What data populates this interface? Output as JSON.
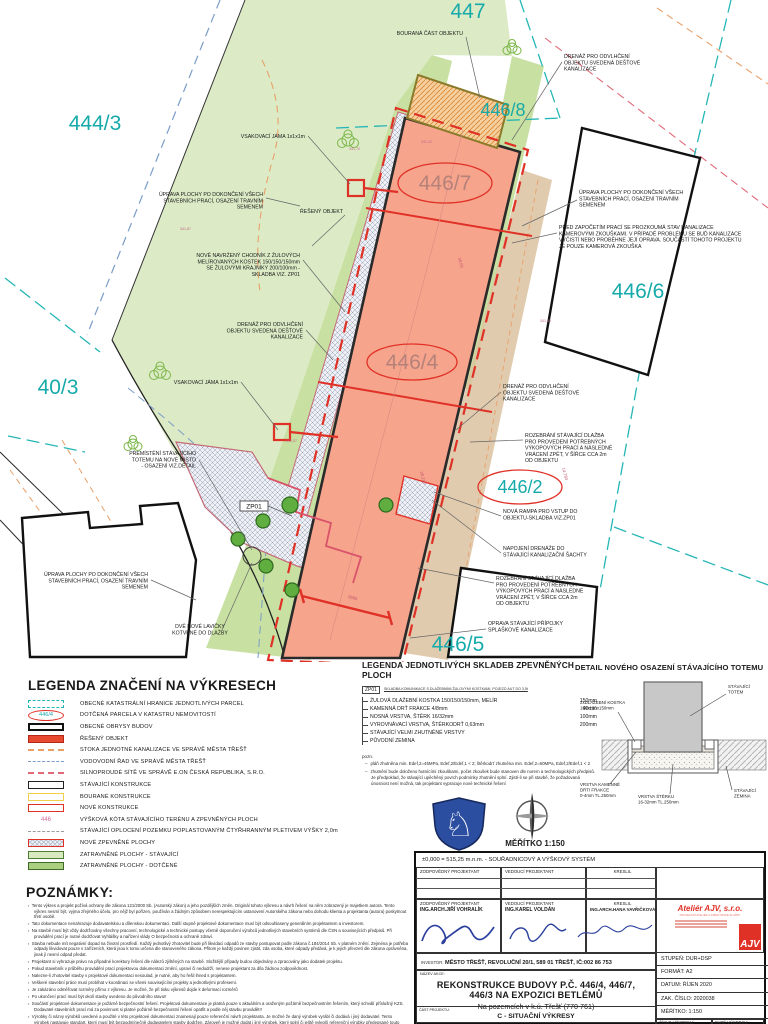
{
  "plan": {
    "parcels": [
      {
        "text": "444/3",
        "x": 95,
        "y": 130,
        "size": 21
      },
      {
        "text": "447",
        "x": 468,
        "y": 18,
        "size": 21
      },
      {
        "text": "446/8",
        "x": 503,
        "y": 116,
        "size": 18
      },
      {
        "text": "446/7",
        "x": 445,
        "y": 190,
        "size": 21,
        "ellipse": [
          445,
          183,
          47,
          20
        ],
        "color": "#b5827a"
      },
      {
        "text": "446/6",
        "x": 638,
        "y": 298,
        "size": 21
      },
      {
        "text": "40/3",
        "x": 58,
        "y": 394,
        "size": 21
      },
      {
        "text": "446/4",
        "x": 412,
        "y": 369,
        "size": 21,
        "ellipse": [
          412,
          362,
          45,
          18
        ],
        "color": "#b5827a"
      },
      {
        "text": "446/2",
        "x": 520,
        "y": 493,
        "size": 18,
        "ellipse": [
          520,
          487,
          42,
          17
        ]
      },
      {
        "text": "446/5",
        "x": 458,
        "y": 651,
        "size": 21
      }
    ],
    "zp01_tag": "ZP01",
    "annotations": [
      {
        "x": 305,
        "y": 138,
        "anchor": "end",
        "lines": [
          "VSAKOVACÍ JÁMA 1x1x1m"
        ],
        "leader": [
          [
            308,
            136
          ],
          [
            350,
            184
          ]
        ]
      },
      {
        "x": 263,
        "y": 196,
        "anchor": "end",
        "lines": [
          "ÚPRAVA PLOCHY PO DOKONČENÍ VŠECH",
          "STAVEBNÍCH PRACÍ, OSAZENÍ TRAVNÍM",
          "SEMENEM"
        ],
        "leader": [
          [
            266,
            198
          ],
          [
            300,
            206
          ]
        ]
      },
      {
        "x": 343,
        "y": 213,
        "anchor": "end",
        "lines": [
          "ŘEŠENÝ OBJEKT"
        ],
        "leader": [
          [
            345,
            215
          ],
          [
            312,
            246
          ]
        ]
      },
      {
        "x": 300,
        "y": 257,
        "anchor": "end",
        "lines": [
          "NOVĚ NAVRŽENÝ CHODNÍK  Z ŽULOVÝCH",
          "MELÍROVANÝCH KOSTEK 150/150/150mm",
          "SE ŽULOVÝMI KRAJNÍKY 200/100mm -",
          "SKLADBA VIZ. ZP01"
        ],
        "leader": [
          [
            303,
            260
          ],
          [
            345,
            312
          ]
        ]
      },
      {
        "x": 303,
        "y": 326,
        "anchor": "end",
        "lines": [
          "DRENÁŽ PRO ODVLHČENÍ",
          "OBJEKTU SVEDENÁ DEŠŤOVÉ",
          "KANALIZACE"
        ],
        "leader": [
          [
            306,
            330
          ],
          [
            333,
            360
          ]
        ]
      },
      {
        "x": 238,
        "y": 384,
        "anchor": "end",
        "lines": [
          "VSAKOVACÍ JÁMA 1x1x1m"
        ],
        "leader": [
          [
            241,
            382
          ],
          [
            278,
            430
          ]
        ]
      },
      {
        "x": 196,
        "y": 455,
        "anchor": "end",
        "lines": [
          "PŘEMÍSTĚNÍ STÁVAJÍCÍHO",
          "TOTEMU NA NOVÉ MÍSTO",
          "- OSAZENÍ VIZ.DETAIL"
        ],
        "leader": [
          [
            199,
            460
          ],
          [
            252,
            550
          ]
        ]
      },
      {
        "x": 148,
        "y": 576,
        "anchor": "end",
        "lines": [
          "ÚPRAVA PLOCHY PO DOKONČENÍ VŠECH",
          "STAVEBNÍCH PRACÍ, OSAZENÍ TRAVNÍM",
          "SEMENEM"
        ],
        "leader": [
          [
            151,
            580
          ],
          [
            196,
            600
          ]
        ]
      },
      {
        "x": 200,
        "y": 628,
        "anchor": "middle",
        "lines": [
          "DVĚ NOVÉ LAVIČKY",
          "KOTVENÉ DO DLAŽBY"
        ],
        "leader": [
          [
            222,
            630
          ],
          [
            252,
            563
          ]
        ]
      },
      {
        "x": 463,
        "y": 35,
        "anchor": "end",
        "lines": [
          "BOURANÁ ČÁST OBJEKTU"
        ],
        "leader": [
          [
            466,
            37
          ],
          [
            480,
            98
          ]
        ]
      },
      {
        "x": 564,
        "y": 58,
        "anchor": "start",
        "lines": [
          "DRENÁŽ PRO ODVLHČENÍ",
          "OBJEKTU SVEDENÁ DEŠŤOVÉ",
          "KANALIZACE"
        ],
        "leader": [
          [
            562,
            62
          ],
          [
            512,
            140
          ]
        ]
      },
      {
        "x": 579,
        "y": 194,
        "anchor": "start",
        "lines": [
          "ÚPRAVA PLOCHY PO DOKONČENÍ VŠECH",
          "STAVEBNÍCH PRACÍ, OSAZENÍ TRAVNÍM",
          "SEMENEM"
        ],
        "leader": [
          [
            577,
            200
          ],
          [
            522,
            226
          ]
        ]
      },
      {
        "x": 559,
        "y": 229,
        "anchor": "start",
        "lines": [
          "PŘED ZAPOČETÍM PRACÍ SE PROZKOUMÁ STAV KANALIZACE",
          "KAMEROVÝMI ZKOUŠKAMI. V PŘÍPADĚ PROBLÉMU SE BUĎ KANALIZACE",
          "VYČISTÍ NEBO PROBĚHNE JEJÍ OPRAVA. SOUČÁSTÍ TOHOTO PROJEKTU",
          "JE POUZE KAMEROVÁ ZKOUŠKA"
        ],
        "leader": [
          [
            557,
            233
          ],
          [
            512,
            243
          ]
        ]
      },
      {
        "x": 503,
        "y": 388,
        "anchor": "start",
        "lines": [
          "DRENÁŽ PRO ODVLHČENÍ",
          "OBJEKTU SVEDENÁ DEŠŤOVÉ",
          "KANALIZACE"
        ],
        "leader": [
          [
            501,
            392
          ],
          [
            456,
            430
          ]
        ]
      },
      {
        "x": 525,
        "y": 437,
        "anchor": "start",
        "lines": [
          "ROZEBRÁNÍ STÁVAJÍCÍ DLAŽBA",
          "PRO PROVEDENÍ POTŘEBNÝCH",
          "VÝKOPOVÝCH PRACÍ A NÁSLEDNÉ",
          "VRÁCENÍ ZPĚT, V ŠÍŘCE CCA 2m",
          "OD OBJEKTU"
        ],
        "leader": [
          [
            523,
            440
          ],
          [
            470,
            442
          ]
        ]
      },
      {
        "x": 503,
        "y": 513,
        "anchor": "start",
        "lines": [
          "NOVÁ RAMPA PRO VSTUP DO",
          "OBJEKTU-SKLADBA VIZ.ZP01"
        ],
        "leader": [
          [
            501,
            516
          ],
          [
            434,
            492
          ]
        ]
      },
      {
        "x": 503,
        "y": 550,
        "anchor": "start",
        "lines": [
          "NAPOJENÍ DRENÁŽE DO",
          "STÁVAJÍCÍ KANALIZAČNÍ ŠACHTY"
        ],
        "leader": [
          [
            501,
            553
          ],
          [
            432,
            500
          ]
        ]
      },
      {
        "x": 496,
        "y": 580,
        "anchor": "start",
        "lines": [
          "ROZEBRÁNÍ STÁVAJÍCÍ DLAŽBA",
          "PRO PROVEDENÍ POTŘEBNÝCH",
          "VÝKOPOVÝCH PRACÍ A NÁSLEDNÉ",
          "VRÁCENÍ ZPĚT, V ŠÍŘCE CCA 2m",
          "OD OBJEKTU"
        ],
        "leader": [
          [
            494,
            583
          ],
          [
            418,
            568
          ]
        ]
      },
      {
        "x": 488,
        "y": 625,
        "anchor": "start",
        "lines": [
          "OPRAVA STÁVAJÍCÍ PŘÍPOJKY",
          "SPLAŠKOVÉ KANALIZACE"
        ],
        "leader": [
          [
            486,
            629
          ],
          [
            410,
            638
          ]
        ]
      }
    ],
    "elevations": [
      {
        "t": "341,70",
        "x": 349,
        "y": 150
      },
      {
        "t": "341,32",
        "x": 421,
        "y": 143
      },
      {
        "t": "341,87",
        "x": 180,
        "y": 230
      },
      {
        "t": "341,57",
        "x": 286,
        "y": 442
      },
      {
        "t": "341,35",
        "x": 540,
        "y": 322
      }
    ],
    "dims": [
      {
        "t": "38,00",
        "x": 458,
        "y": 258,
        "r": 75
      },
      {
        "t": "28,210",
        "x": 420,
        "y": 472,
        "r": 75
      },
      {
        "t": "14,780",
        "x": 562,
        "y": 468,
        "r": 75
      },
      {
        "t": "8565",
        "x": 348,
        "y": 598,
        "r": 14
      }
    ]
  },
  "legend1": {
    "title": "LEGENDA ZNAČENÍ NA VÝKRESECH",
    "items": [
      {
        "kind": "rect-dash-teal",
        "label": "OBECNÉ KATASTRÁLNÍ HRANICE JEDNOTLIVÝCH PARCEL"
      },
      {
        "kind": "ellipse-446",
        "tag": "446/4",
        "label": "DOTČENÁ PARCELA V KATASTRU NEMOVITOSTÍ"
      },
      {
        "kind": "rect-black-thick",
        "label": "OBECNÉ OBRYSY BUDOV"
      },
      {
        "kind": "rect-red-fill",
        "label": "ŘEŠENÝ OBJEKT"
      },
      {
        "kind": "line-dash-orange",
        "label": "STOKA JEDNOTNÉ KANALIZACE VE SPRÁVĚ MĚSTA TŘEŠŤ"
      },
      {
        "kind": "line-dash-blue",
        "label": "VODOVODNÍ ŘAD VE SPRÁVĚ MĚSTA TŘEŠŤ"
      },
      {
        "kind": "line-dash-red",
        "label": "SILNOPROUDÉ SÍTĚ VE SPRÁVĚ E.ON ČESKÁ REPUBLIKA, S.R.O."
      },
      {
        "kind": "rect-black",
        "label": "STÁVAJÍCÍ KONSTRUKCE"
      },
      {
        "kind": "rect-yellow",
        "label": "BOURANÉ KONSTRUKCE"
      },
      {
        "kind": "rect-red",
        "label": "NOVÉ KONSTRUKCE"
      },
      {
        "kind": "text-446",
        "tag": "446",
        "label": "VÝŠKOVÁ KÓTA STÁVAJÍCÍHO TERÉNU A ZPEVNĚNÝCH PLOCH"
      },
      {
        "kind": "line-fence",
        "label": "STÁVAJÍCÍ OPLOCENÍ POZEMKU POPLASTOVANÝM ČTYŘHRANNÝM PLETIVEM VÝŠKY 2,0m"
      },
      {
        "kind": "rect-hatch",
        "label": "NOVÉ ZPEVNĚNÉ PLOCHY"
      },
      {
        "kind": "rect-green-light",
        "label": "ZATRAVNĚNÉ PLOCHY - STÁVAJÍCÍ"
      },
      {
        "kind": "rect-green-dark",
        "label": "ZATRAVNĚNÉ PLOCHY - DOTČENÉ"
      }
    ]
  },
  "legend2": {
    "title": "LEGENDA JEDNOTLIVÝCH SKLADEB ZPEVNĚNÝCH PLOCH",
    "code": "ZP01",
    "caption": "SKLADBA KOMUNIKACE S DLAŽEBNÍMI ŽULOVÝMI KOSTKAMI, POJEZD AUT DO 3,5t",
    "layers": [
      {
        "name": "ŽULOVÁ DLAŽEBNÍ KOSTKA 150/150/150mm, MELÍR",
        "t": "150mm"
      },
      {
        "name": "KAMENNÁ DRŤ FRAKCE 4/8mm",
        "t": "40mm"
      },
      {
        "name": "NOSNÁ VRSTVA, ŠTĚRK 16/32mm",
        "t": "100mm"
      },
      {
        "name": "VYROVNÁVACÍ VRSTVA, ŠTĚRKODRŤ 0,63mm",
        "t": "200mm"
      },
      {
        "name": "STÁVAJÍCÍ VELMI ZHUTNĚNÉ VRSTVY",
        "t": ""
      },
      {
        "name": "PŮVODNÍ ZEMINA",
        "t": ""
      }
    ],
    "pozn_label": "pozn.",
    "pozn": [
      "pláň zhutněna min. Edef,2=45MPa, Edef,2/Edef,1 < 2;   štěrkodrť zhutněna min. Edef,2=60MPa, Edef,2/Edef,1 < 2",
      "zhutnění bude doloženo hutnícími zkouškami, počet zkoušek bude stanoven dle norem a technologických předpisů. Je předpoklad, že stávající upěchěný povrch podmínky zhutnění splní. Zjistí-li se při stavbě, že požadovaná únosnost není možná, tak projektant vypracuje nové technické řešení"
    ]
  },
  "detail": {
    "title": "DETAIL NOVÉHO OSAZENÍ STÁVAJÍCÍHO TOTEMU",
    "labels": [
      {
        "x": 150,
        "y": 12,
        "anchor": "start",
        "lines": [
          "STÁVAJÍCÍ",
          "TOTEM"
        ],
        "leader": [
          [
            148,
            18
          ],
          [
            112,
            40
          ]
        ]
      },
      {
        "x": 2,
        "y": 28,
        "anchor": "start",
        "lines": [
          "2xDLAŽEBNÍ KOSTKA",
          "150x150x150mm"
        ],
        "leader": [
          [
            40,
            36
          ],
          [
            57,
            66
          ]
        ]
      },
      {
        "x": 2,
        "y": 110,
        "anchor": "start",
        "lines": [
          "VRSTVA KAMENNÉ",
          "DRTI FRAKCE",
          "0-4mm TL.250mm"
        ],
        "leader": [
          [
            32,
            108
          ],
          [
            58,
            76
          ]
        ]
      },
      {
        "x": 60,
        "y": 122,
        "anchor": "start",
        "lines": [
          "VRSTVA ŠTĚRKU",
          "16-32mm TL.250mm"
        ],
        "leader": [
          [
            92,
            118
          ],
          [
            95,
            88
          ]
        ]
      },
      {
        "x": 156,
        "y": 116,
        "anchor": "start",
        "lines": [
          "STÁVAJÍCÍ",
          "ZEMINA"
        ],
        "leader": [
          [
            154,
            114
          ],
          [
            148,
            90
          ]
        ]
      }
    ]
  },
  "scale_label": "MĚŘÍTKO 1:150",
  "notes": {
    "title": "POZNÁMKY:",
    "items": [
      "Tento výkres a projekt požívá ochrany dle zákona 121/2000 Sb. (Autorský zákon) a jeho pozdějších změn. Originál tohoto výkresu a návrh řešení na něm zobrazený je majetkem autora. Tento výkres nesmí být, vyjma zřejmého účelu, pro nějž byl pořízen, používán a žádným způsobem nerespektujícím ustanovení Autorského zákona nebo dohodu klienta a  projektanta (autora) poskytnout třetí osobě.",
      "Tato dokumentace nenahrazuje dodavatelskou a dílenskou dokumentaci. Další stupně projektové dokumentace musí být odsouhlaseny generálním projektantem a investorem.",
      "Na stavbě musí být vždy dodržovány všechny pracovní, technologické a technické postupy včetně doporučení výrobců jednotlivých stavebních systémů dle ČSN a souvisejících předpisů. Při provádění prací je nutné dodržovat Vyhlášky a nařízení vlády O bezpečnosti a ochraně zdraví.",
      "Stavba nebude mít negativní dopad na životní prostředí. Každý jednotlivý zhotovitel bude při likvidaci odpadů ze stavby postupovat podle zákona č.184/2014 Sb. v platném znění. Zejména je potřeba odpady likvidovat pouze v zařízeních, která jsou k tomu určena dle stanoveného zákona. Přitom je každý povinen zjistit, zda osoba, které odpady předává, je k jejich převzetí dle zákona oprávněna, jinak jí nesmí odpad předat.",
      "Projektant si vyhrazuje právo na případné korektury řešení dle nálezů zjištěných na stavbě. Složitější případy budou objednány a zpracovány jako dodatek projektu.",
      "Pokud stavebník v průběhu provádění prací projektovou dokumentaci změní, upraví či nedodrží, nenese projektant za díla žádnou zodpovědnost.",
      "Nalezne-li zhotovitel stavby v projektové dokumentaci nesoulad, je nutné, aby ho řešil ihned s projektantem.",
      "Veškeré stavební práce musí probíhat v koordinaci se všemi souvisejícími projekty a jednotlivými profesemi.",
      "Je zakázáno odměřovat rozměry přímo z výkresu. Je možné, že při tisku výkresů dojde k deformaci rozměrů",
      "Po ukončení prací musí být okolí stavby uvedeno do původního stavu!!",
      "Součástí projektové dokumentace je požárně bezpečnostní řešení. Projektová dokumentace je platná pouze s aktuálním a oraženým požárně bezpečnostním řešením, který schválí příslušný KZS. Dodavatel stavebních prací má za povinnost si platné požárně bezpečnostní řešení opatřit a podle něj stavbu provádět!!",
      "Výrobky či názvy výrobků uvedené a použité v této projektové dokumentaci znamenají pouze referenční návrh projektanta. Je možné že daný výrobek vyrábí či dodává i jiný dodavatel. Tento výrobek nastavuje standart, který musí být bezpodmínečně dodavatelem stavby dodržen. Zároveň je možné dodat i jiný výrobek, který splní či ještě vylepší referenční výrobky předepsané touto projektovou dokumentací. V případě změny je nutné její odsouhlasení generálním projektantem, autorským dozorem stavby nebo investorem."
    ]
  },
  "titleblock": {
    "datum_line": "±0,000 = 515,25  m.n.m. - SOUŘADNICOVÝ A VÝŠKOVÝ SYSTÉM",
    "role1": "ZODPOVĚDNÝ PROJEKTANT",
    "role2": "VEDOUCÍ PROJEKTANT",
    "role3": "KRESLIL",
    "name1": "ING.ARCH.JIŘÍ VOHRALÍK",
    "name2": "ING.KAREL VOLDÁN",
    "name3": "ING.ARCH.HANA VAVŘIČKOVÁ",
    "investor_label": "INVESTOR:",
    "investor": "MĚSTO TŘEŠŤ, REVOLUČNÍ 20/1, 589 01 TŘEŠŤ, IČ:002 86 753",
    "nazev_label": "NÁZEV AKCE:",
    "title_line1": "REKONSTRUKCE BUDOVY P.Č. 446/4, 446/7,",
    "title_line2": "446/3 NA EXPOZICI BETLÉMŮ",
    "subtitle": "Na pozemcích v k.ú. Třešť (770 761)",
    "stupen": "STUPEŇ: DUR+DSP",
    "format": "FORMÁT: A2",
    "datum": "DATUM: ŘÍJEN 2020",
    "zak": "ZAK. ČÍSLO: 2020038",
    "meritko": "MĚŘÍTKO: 1:150",
    "cast_label": "ČÁST PROJEKTU:",
    "cast": "C - SITUAČNÍ VÝKRESY",
    "cislo_label": "ČÍSLO VÝKRESU:",
    "pare_label": "PARÉ VÝKRESU:",
    "company": {
      "name": "Ateliér AJV, s.r.o.",
      "tagline": "PROJEKČNÍ ATELIÉR A INŽENÝRSKÉ SLUŽBY",
      "logo": "AJV"
    }
  }
}
